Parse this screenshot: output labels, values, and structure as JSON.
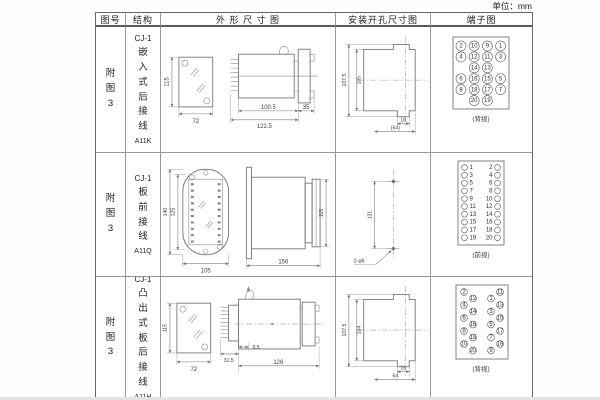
{
  "page": {
    "unit_label": "单位：mm"
  },
  "headers": {
    "fig": "图号",
    "structure": "结构",
    "outline": "外 形 尺 寸 图",
    "install": "安装开孔尺寸图",
    "terminal": "端子图"
  },
  "rows": [
    {
      "fig": "附图3",
      "model": "CJ-1",
      "name": "嵌入式后接线",
      "code": "A11K",
      "outline": {
        "front_h": "115",
        "front_w": "72",
        "body_len": "100.5",
        "total_len": "122.5",
        "flange": "35"
      },
      "install": {
        "outer": "107.5",
        "inner": "105",
        "tab": "16",
        "width": "(64)"
      },
      "terminal": {
        "type": "grid",
        "label": "(背视)",
        "grid": [
          [
            "2",
            "10",
            "9",
            "1"
          ],
          [
            "4",
            "12",
            "11",
            "3"
          ],
          [
            "",
            "14",
            "13",
            ""
          ],
          [
            "6",
            "16",
            "15",
            "5"
          ],
          [
            "8",
            "18",
            "17",
            "7"
          ],
          [
            "",
            "20",
            "19",
            ""
          ]
        ]
      }
    },
    {
      "fig": "附图3",
      "model": "CJ-1",
      "name": "板前接线",
      "code": "A11Q",
      "outline": {
        "oval_h": "140",
        "inner_h": "125",
        "width": "105",
        "side_len": "156",
        "side_h": "115"
      },
      "install": {
        "pitch": "131",
        "holes": "2-φ6"
      },
      "terminal": {
        "type": "columns",
        "label": "(前视)",
        "left": [
          "1",
          "3",
          "5",
          "7",
          "9",
          "11",
          "13",
          "15",
          "17",
          "19"
        ],
        "right": [
          "2",
          "4",
          "6",
          "8",
          "10",
          "12",
          "14",
          "16",
          "18",
          "20"
        ]
      }
    },
    {
      "fig": "附图3",
      "model": "CJ-1",
      "name": "凸出式板后接线",
      "code": "A11H",
      "outline": {
        "front_h": "115",
        "front_w": "72",
        "pins_len": "31.5",
        "offset": "9.5",
        "total_len": "126"
      },
      "install": {
        "outer": "107.5",
        "inner": "104",
        "tab": "16",
        "width": "64"
      },
      "terminal": {
        "type": "zigzag",
        "label": "(背视)",
        "left": [
          "2",
          "12",
          "4",
          "14",
          "6",
          "16",
          "8",
          "18",
          "10",
          "20"
        ],
        "right": [
          "11",
          "1",
          "13",
          "3",
          "15",
          "5",
          "17",
          "7",
          "19",
          "9"
        ]
      }
    }
  ]
}
